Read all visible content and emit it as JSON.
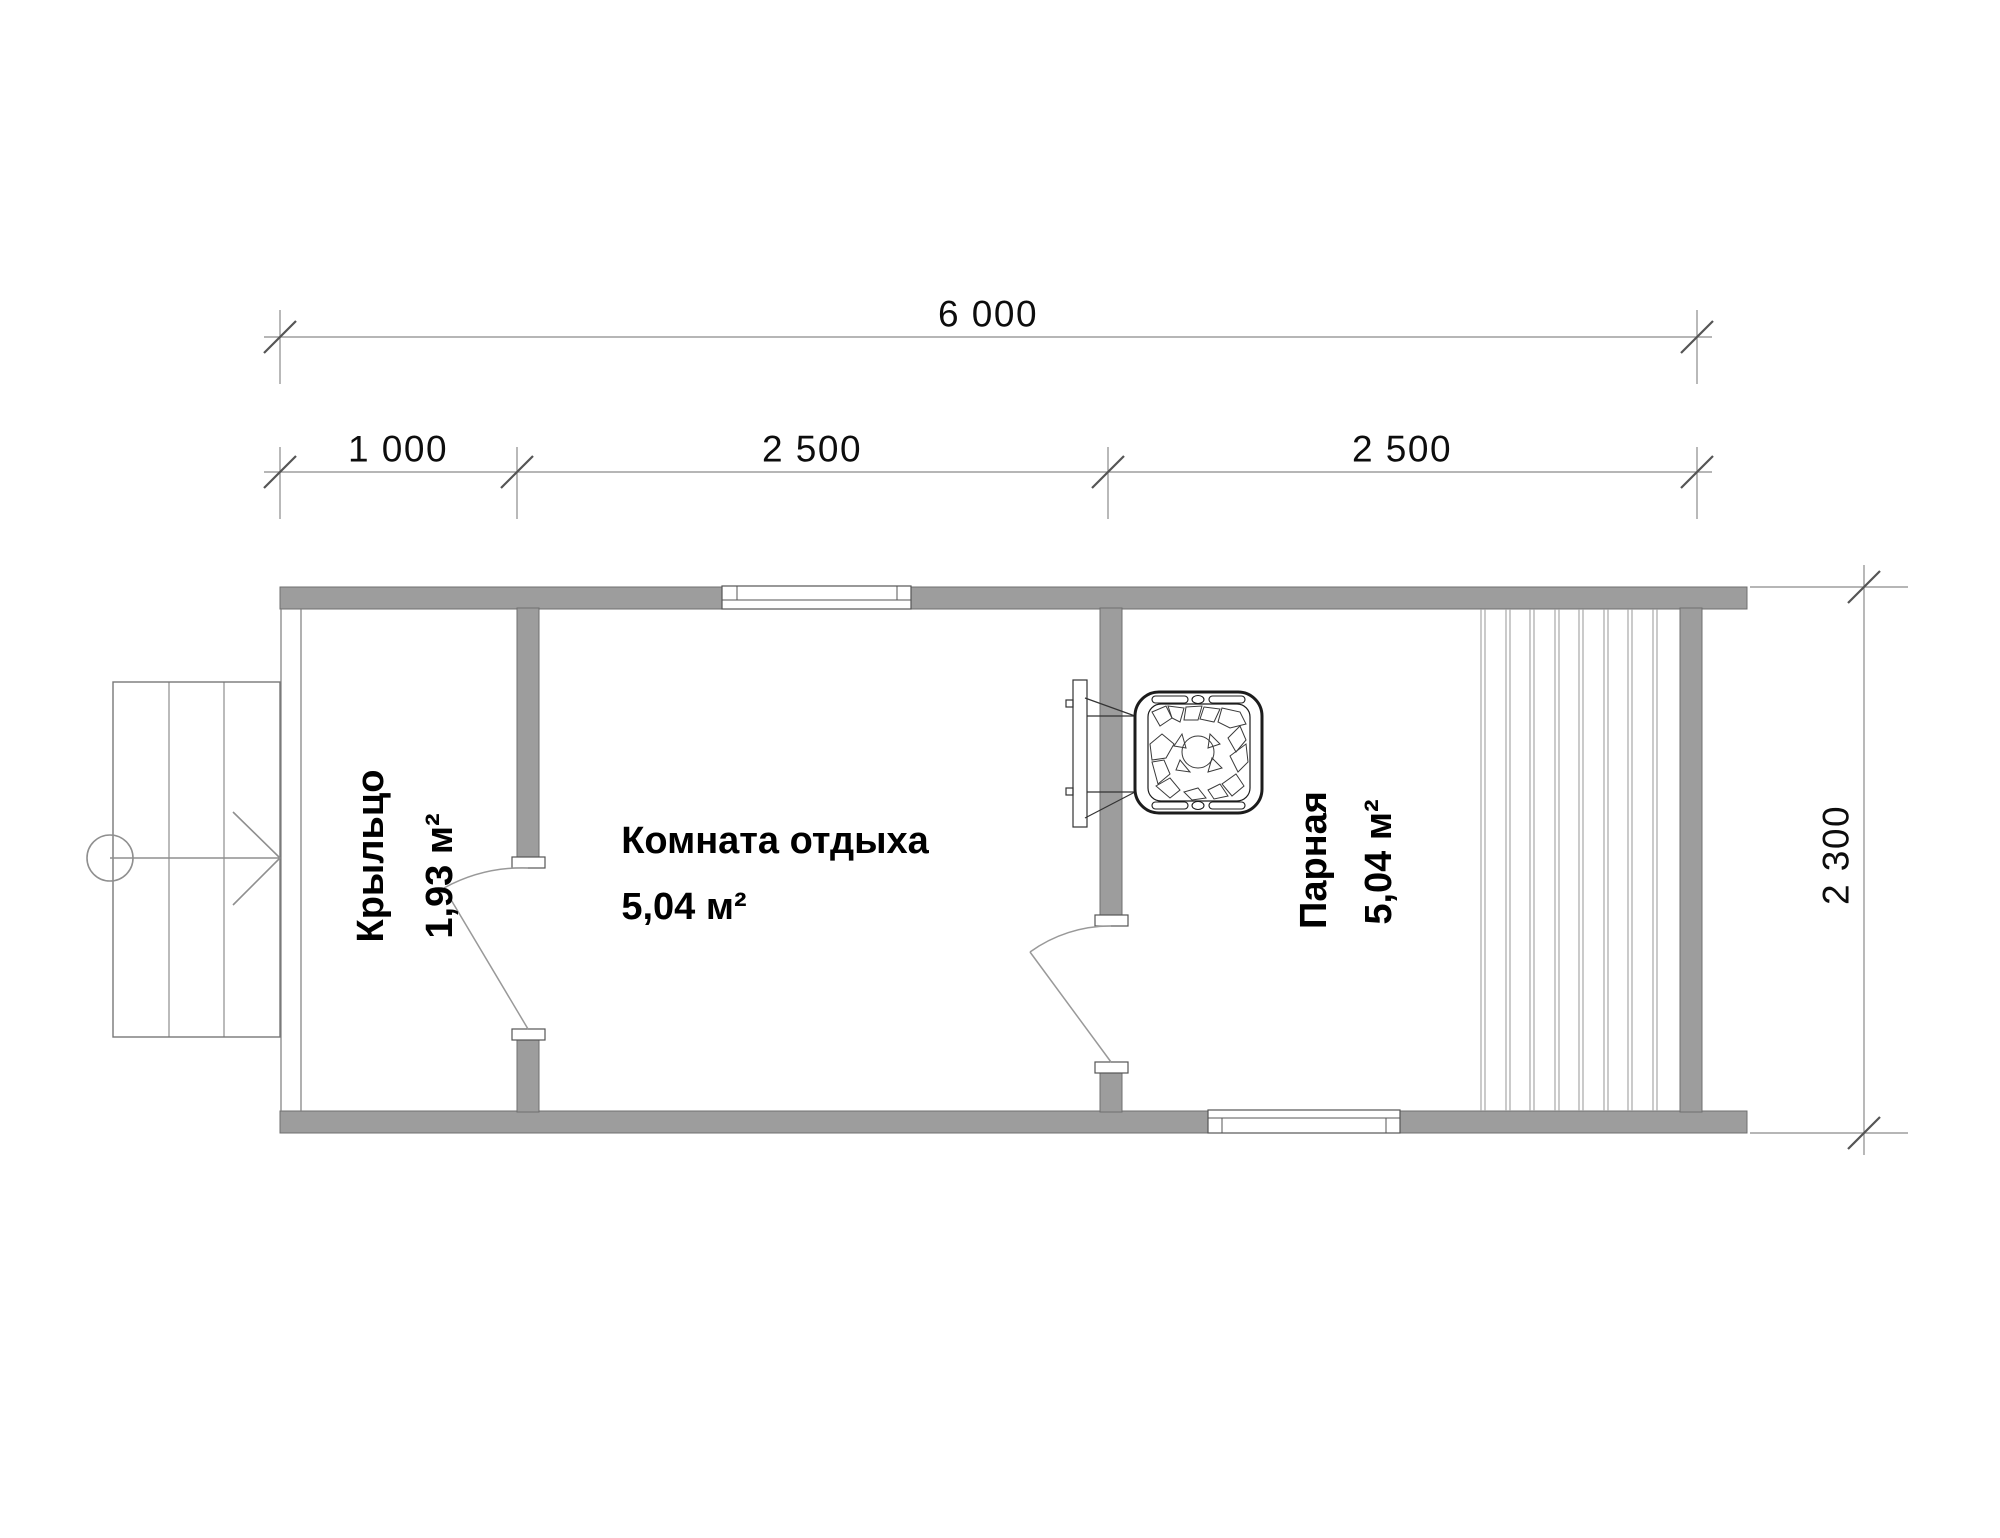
{
  "dimensions": {
    "total": "6 000",
    "segments": [
      "1 000",
      "2 500",
      "2 500"
    ],
    "height": "2 300"
  },
  "rooms": [
    {
      "name": "Крыльцо",
      "area": "1,93 м²"
    },
    {
      "name": "Комната отдыха",
      "area": "5,04 м²"
    },
    {
      "name": "Парная",
      "area": "5,04 м²"
    }
  ],
  "colors": {
    "wall_fill": "#9d9d9d",
    "wall_outline": "#6f6f6f",
    "thin_line": "#8a8a8a",
    "stove_line": "#1c1c1c",
    "text": "#000000"
  }
}
